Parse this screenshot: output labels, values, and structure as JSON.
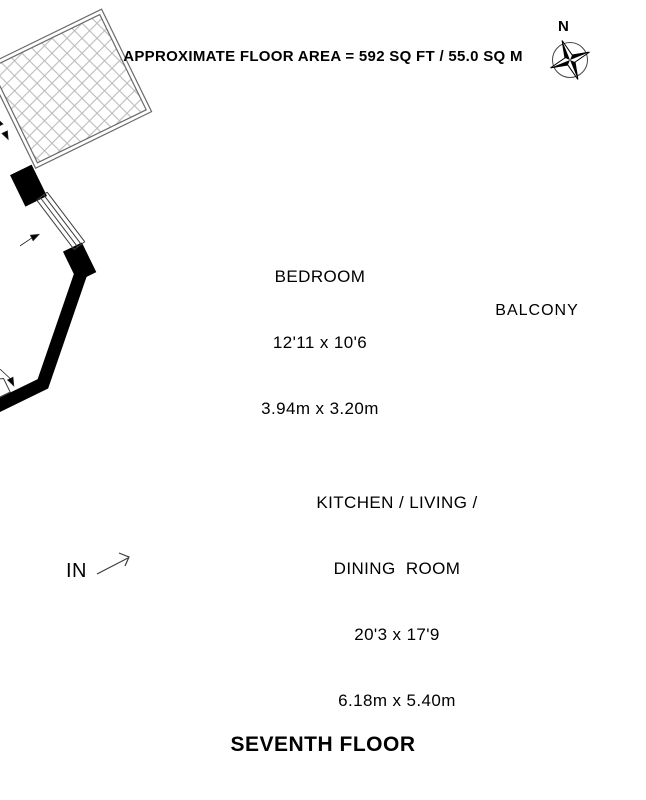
{
  "header": {
    "title": "APPROXIMATE FLOOR AREA = 592 SQ FT / 55.0 SQ M"
  },
  "footer": {
    "title": "SEVENTH FLOOR"
  },
  "compass": {
    "label": "N"
  },
  "entrance": {
    "label": "IN"
  },
  "rooms": {
    "bedroom": {
      "name": "BEDROOM",
      "dims_imperial": "12'11 x 10'6",
      "dims_metric": "3.94m x 3.20m"
    },
    "kitchen": {
      "name_line1": "KITCHEN / LIVING /",
      "name_line2": "DINING  ROOM",
      "dims_imperial": "20'3 x 17'9",
      "dims_metric": "6.18m x 5.40m"
    },
    "balcony": {
      "name": "BALCONY"
    }
  },
  "colors": {
    "wall": "#000000",
    "thin_line": "#3c3c3c",
    "hatch": "#b8b8b8"
  }
}
